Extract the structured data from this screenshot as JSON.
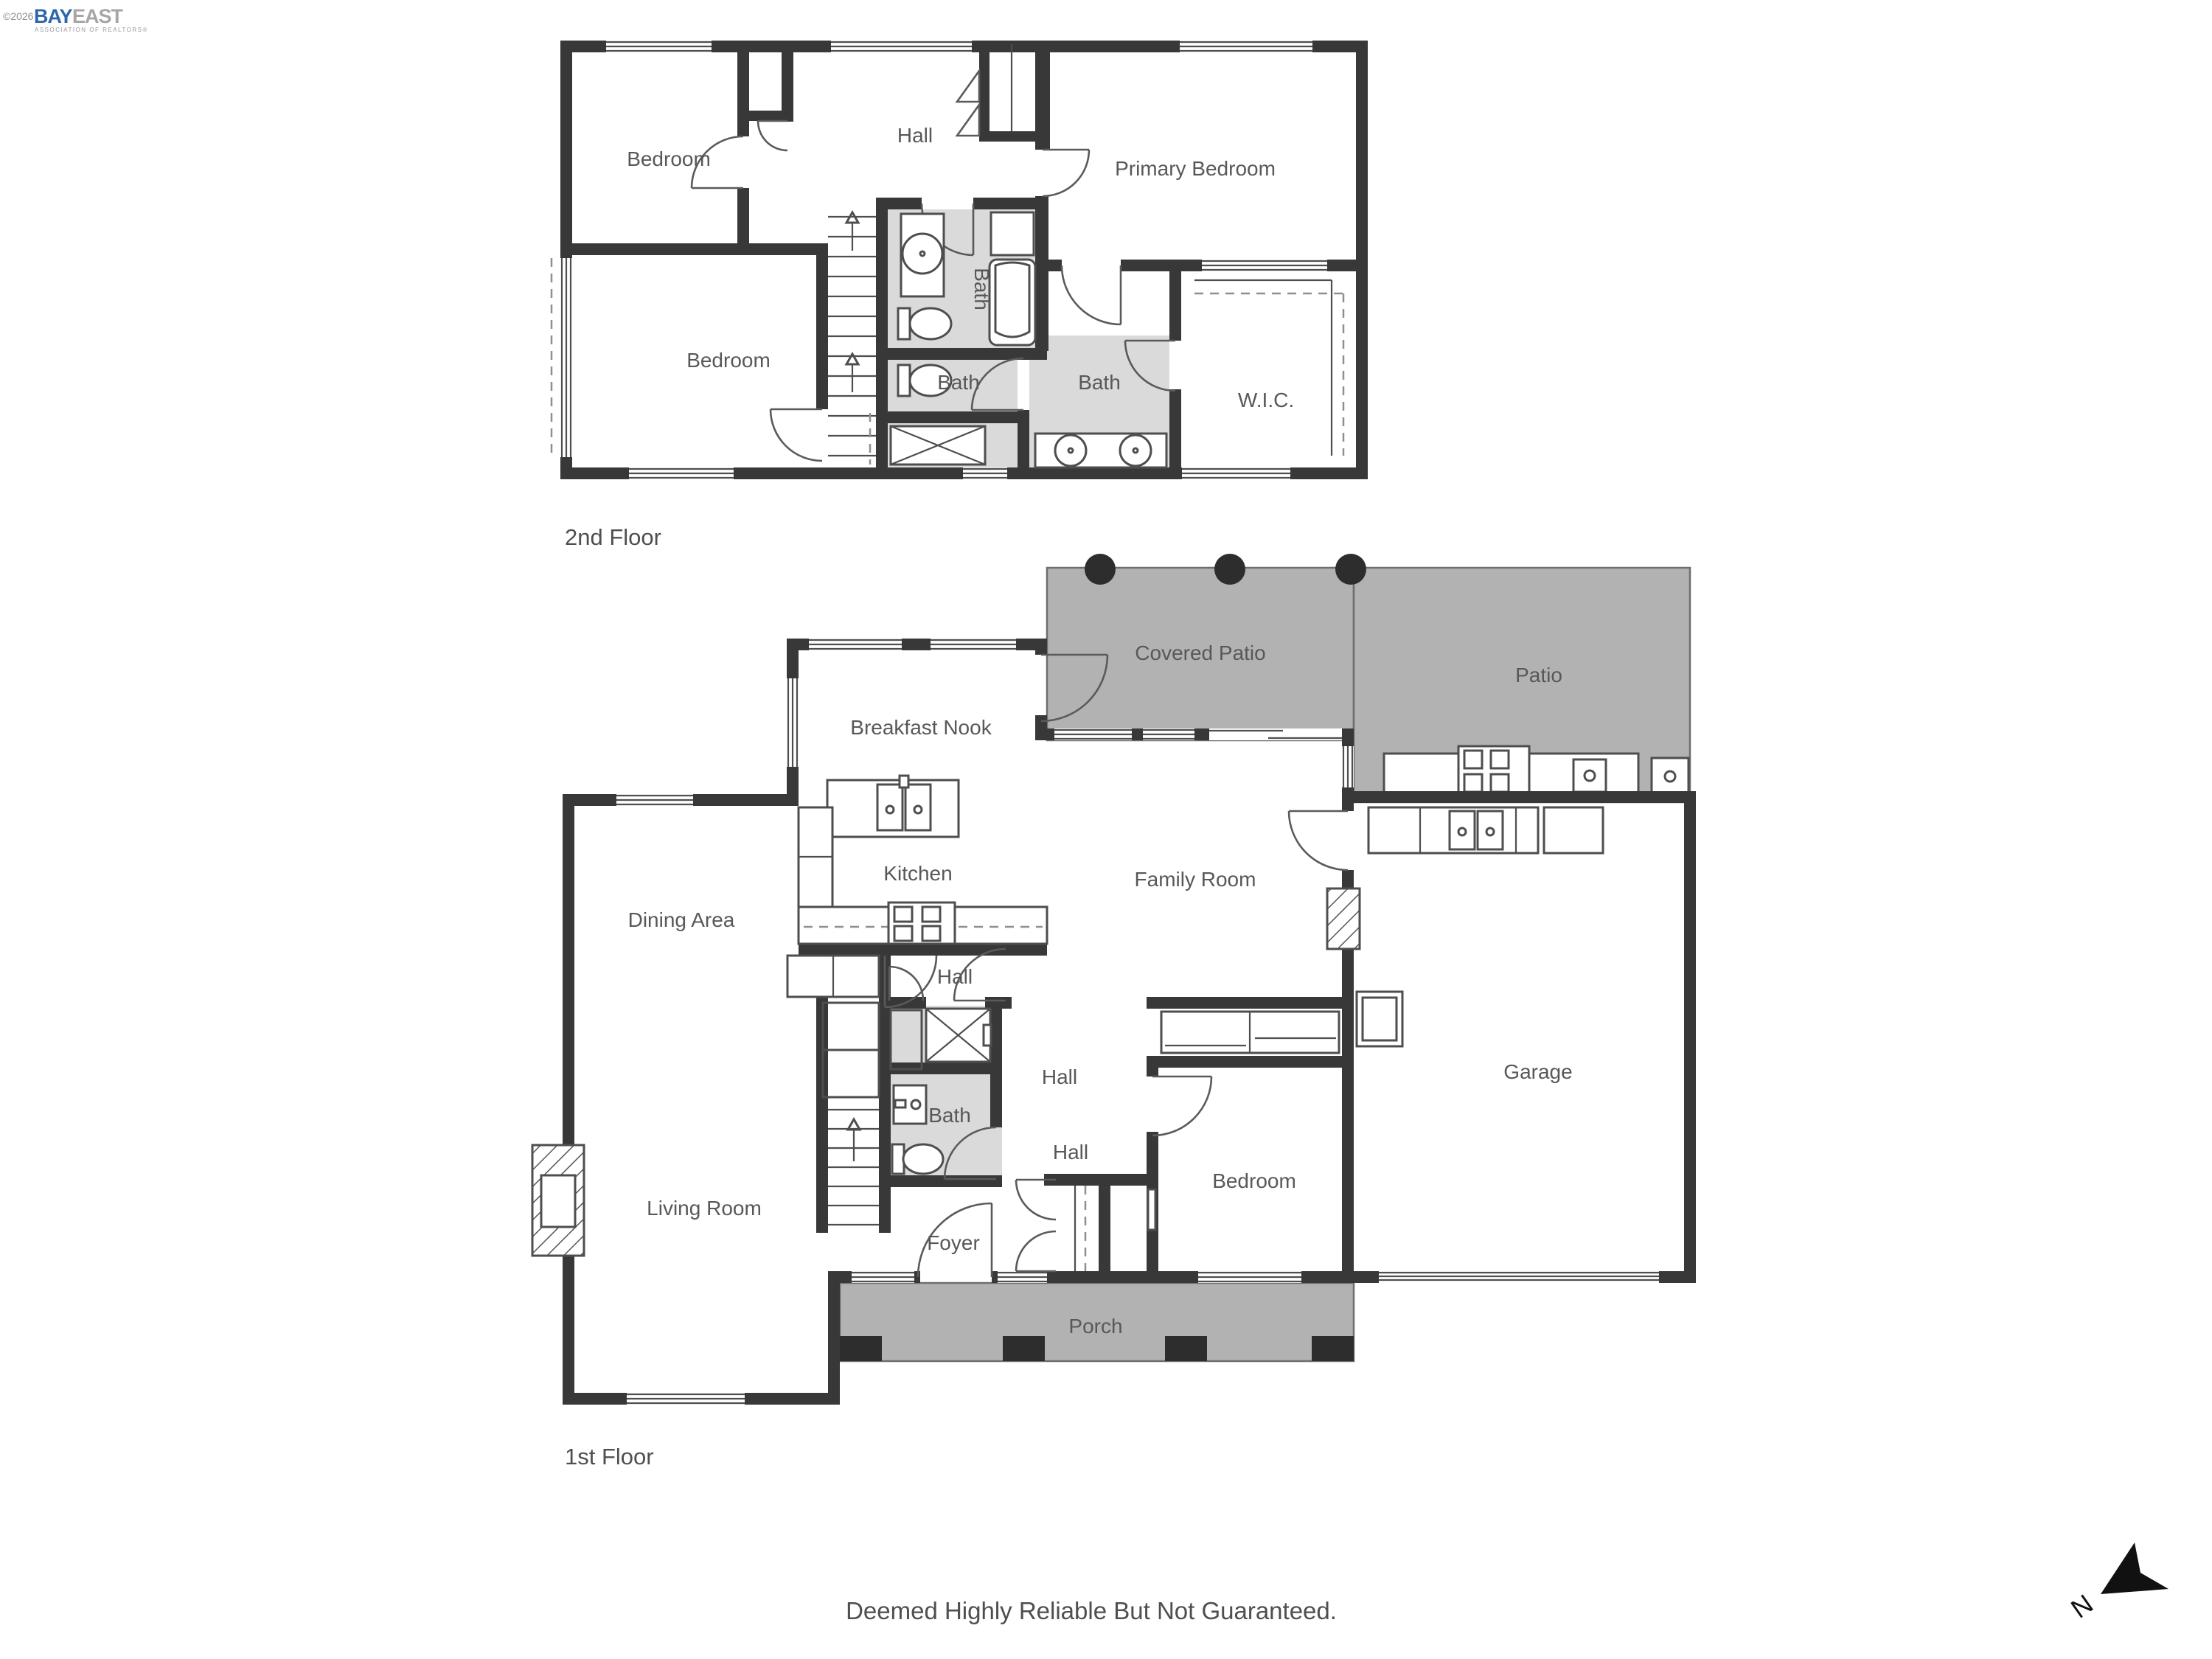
{
  "logo": {
    "copyright": "©2026",
    "brand_bay": "BAY",
    "brand_east": "EAST",
    "tagline": "ASSOCIATION OF REALTORS®"
  },
  "floors": {
    "second": {
      "caption": "2nd Floor",
      "labels": {
        "bedroom_top": "Bedroom",
        "hall": "Hall",
        "primary_bedroom": "Primary Bedroom",
        "bath_center": "Bath",
        "bedroom_bottom": "Bedroom",
        "bath_lower": "Bath",
        "bath_primary": "Bath",
        "wic": "W.I.C."
      }
    },
    "first": {
      "caption": "1st Floor",
      "labels": {
        "covered_patio": "Covered Patio",
        "patio": "Patio",
        "breakfast_nook": "Breakfast Nook",
        "kitchen": "Kitchen",
        "family_room": "Family Room",
        "dining_area": "Dining Area",
        "hall_upper": "Hall",
        "hall_mid": "Hall",
        "bath": "Bath",
        "hall_lower": "Hall",
        "living_room": "Living Room",
        "bedroom": "Bedroom",
        "garage": "Garage",
        "foyer": "Foyer",
        "porch": "Porch"
      }
    }
  },
  "footer": {
    "disclaimer": "Deemed Highly Reliable But Not Guaranteed."
  },
  "compass": {
    "north": "N"
  },
  "colors": {
    "wall": "#383838",
    "bath_floor": "#dadada",
    "patio_floor": "#b2b2b2",
    "brand_blue": "#2e66ad",
    "label_text": "#585858"
  }
}
